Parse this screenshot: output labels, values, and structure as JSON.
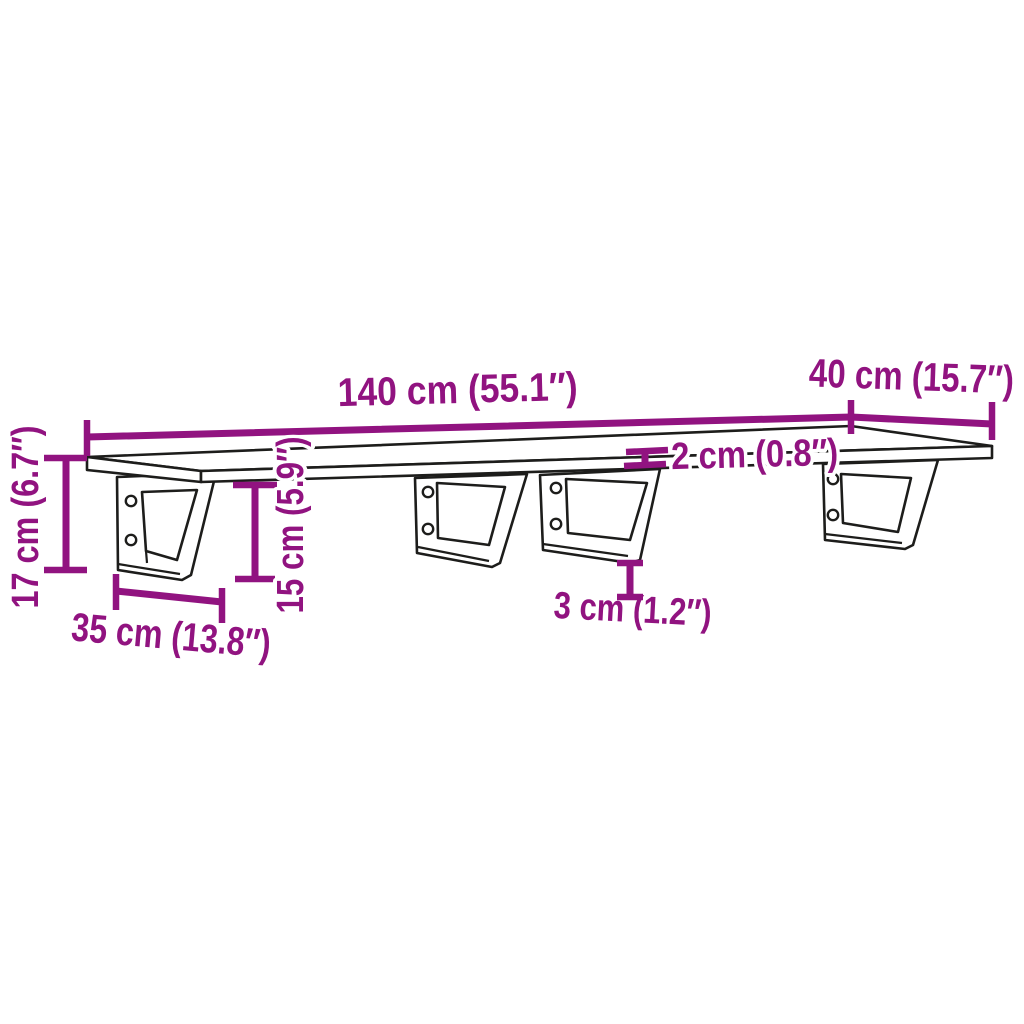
{
  "diagram": {
    "type": "product-dimension-drawing",
    "subject": "wall-mounted shelf board with four steel brackets",
    "colors": {
      "dimension_annotation": "#911380",
      "outline": "#1d1d1b",
      "background": "#ffffff"
    },
    "dims": {
      "length": "140 cm (55.1″)",
      "depth": "40 cm (15.7″)",
      "thickness": "2 cm (0.8″)",
      "height": "17 cm (6.7″)",
      "bracket_height": "15 cm (5.9″)",
      "bracket_depth": "35 cm (13.8″)",
      "bracket_thickness": "3 cm (1.2″)"
    }
  }
}
